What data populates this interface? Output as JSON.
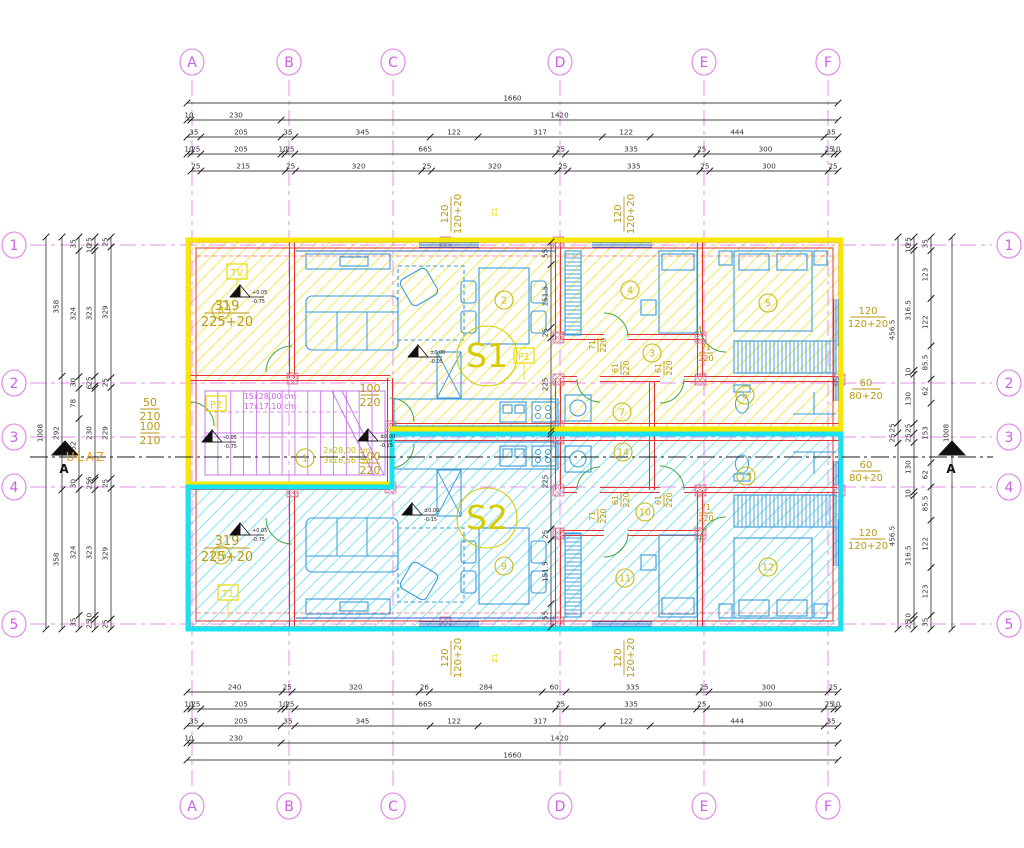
{
  "canvas": {
    "width": 1024,
    "height": 848,
    "bg": "#ffffff"
  },
  "colors": {
    "grid": "#e07ee8",
    "axis_text": "#cf5fe8",
    "unit1_border": "#f6e800",
    "unit2_border": "#19e3f2",
    "unit1_hatch": "#f2e23c",
    "unit2_hatch": "#5fe0ec",
    "wall": "#e03535",
    "dim_line": "#444444",
    "dim_text": "#333333",
    "olive": "#bb9912",
    "furniture": "#3b9bd9",
    "stair": "#c877e8",
    "room": "#c9b80e",
    "unit_label": "#d8ca00",
    "section": "#1a1a1a",
    "door": "#46a546",
    "window": "#2a62c8",
    "pier": "#e8a0c0",
    "orange": "#e8a02a",
    "label_yellow": "#e8dc00"
  },
  "axes": {
    "cols": [
      {
        "label": "A",
        "x": 192
      },
      {
        "label": "B",
        "x": 289
      },
      {
        "label": "C",
        "x": 393
      },
      {
        "label": "D",
        "x": 560
      },
      {
        "label": "E",
        "x": 704
      },
      {
        "label": "F",
        "x": 828
      }
    ],
    "rows": [
      {
        "label": "1",
        "y": 245
      },
      {
        "label": "2",
        "y": 383
      },
      {
        "label": "3",
        "y": 437
      },
      {
        "label": "4",
        "y": 487
      },
      {
        "label": "5",
        "y": 624
      }
    ],
    "top_cy": 62,
    "bottom_cy": 806,
    "left_cx": 14,
    "right_cx": 1009,
    "r": 13,
    "v_y1": 80,
    "v_y2": 790,
    "h_x1": 30,
    "h_x2": 992
  },
  "dim_chains": {
    "top": [
      {
        "y": 103,
        "x1": 187,
        "x2": 838,
        "values": [
          "1660"
        ]
      },
      {
        "y": 120,
        "x1": 187,
        "x2": 838,
        "values": [
          "10",
          "230",
          "1420"
        ]
      },
      {
        "y": 137,
        "x1": 187,
        "x2": 838,
        "values": [
          "35",
          "205",
          "35",
          "345",
          "122",
          "317",
          "122",
          "444",
          "35"
        ]
      },
      {
        "y": 154,
        "x1": 187,
        "x2": 838,
        "values": [
          "10",
          "25",
          "205",
          "10",
          "25",
          "665",
          "25",
          "335",
          "25",
          "300",
          "25",
          "10"
        ]
      },
      {
        "y": 171,
        "x1": 191,
        "x2": 838,
        "values": [
          "25",
          "215",
          "25",
          "320",
          "25",
          "320",
          "25",
          "335",
          "25",
          "300",
          "25"
        ]
      }
    ],
    "bottom": [
      {
        "y": 692,
        "x1": 187,
        "x2": 838,
        "values": [
          "240",
          "25",
          "320",
          "26",
          "284",
          "60",
          "335",
          "25",
          "300",
          "25"
        ]
      },
      {
        "y": 709,
        "x1": 187,
        "x2": 838,
        "values": [
          "10",
          "25",
          "205",
          "10",
          "25",
          "665",
          "25",
          "335",
          "25",
          "300",
          "25",
          "10"
        ]
      },
      {
        "y": 726,
        "x1": 187,
        "x2": 838,
        "values": [
          "35",
          "205",
          "35",
          "345",
          "122",
          "317",
          "122",
          "444",
          "35"
        ]
      },
      {
        "y": 743,
        "x1": 187,
        "x2": 838,
        "values": [
          "10",
          "230",
          "1420"
        ]
      },
      {
        "y": 760,
        "x1": 187,
        "x2": 838,
        "values": [
          "1660"
        ]
      }
    ],
    "left": [
      {
        "x": 46,
        "y1": 237,
        "y2": 629,
        "values": [
          "1008"
        ]
      },
      {
        "x": 62,
        "y1": 237,
        "y2": 629,
        "values": [
          "358",
          "292",
          "358"
        ]
      },
      {
        "x": 79,
        "y1": 237,
        "y2": 629,
        "values": [
          "35",
          "324",
          "30",
          "78",
          "152",
          "30",
          "324",
          "35"
        ]
      },
      {
        "x": 95,
        "y1": 237,
        "y2": 629,
        "values": [
          "25",
          "10",
          "323",
          "25",
          "6",
          "230",
          "6",
          "25",
          "323",
          "10",
          "25"
        ]
      },
      {
        "x": 111,
        "y1": 237,
        "y2": 629,
        "values": [
          "25",
          "329",
          "25",
          "229",
          "25",
          "329",
          "25"
        ]
      }
    ],
    "right": [
      {
        "x": 898,
        "y1": 237,
        "y2": 629,
        "values": [
          "456.5",
          "25",
          "25",
          "456.5"
        ]
      },
      {
        "x": 914,
        "y1": 237,
        "y2": 629,
        "values": [
          "25",
          "10",
          "316.5",
          "10",
          "130",
          "25",
          "25",
          "130",
          "10",
          "316.5",
          "10",
          "25"
        ]
      },
      {
        "x": 931,
        "y1": 237,
        "y2": 629,
        "values": [
          "35",
          "123",
          "122",
          "85.5",
          "62",
          "153",
          "62",
          "85.5",
          "122",
          "123",
          "35"
        ]
      },
      {
        "x": 952,
        "y1": 237,
        "y2": 629,
        "values": [
          "1008"
        ]
      }
    ],
    "interior": [
      {
        "x": 551,
        "y1": 242,
        "y2": 431,
        "values": [
          "55",
          "151.5",
          "25",
          "225"
        ]
      },
      {
        "x": 551,
        "y1": 434,
        "y2": 627,
        "values": [
          "225",
          "25",
          "151.5",
          "55"
        ]
      }
    ]
  },
  "rooms": [
    {
      "num": "1",
      "x": 305,
      "y": 458
    },
    {
      "num": "2",
      "x": 504,
      "y": 300
    },
    {
      "num": "3",
      "x": 652,
      "y": 353
    },
    {
      "num": "4",
      "x": 630,
      "y": 290
    },
    {
      "num": "5",
      "x": 768,
      "y": 303
    },
    {
      "num": "6",
      "x": 745,
      "y": 395
    },
    {
      "num": "7",
      "x": 622,
      "y": 412
    },
    {
      "num": "8",
      "x": 221,
      "y": 310
    },
    {
      "num": "9",
      "x": 504,
      "y": 566
    },
    {
      "num": "10",
      "x": 645,
      "y": 512
    },
    {
      "num": "11",
      "x": 625,
      "y": 578
    },
    {
      "num": "12",
      "x": 768,
      "y": 567
    },
    {
      "num": "13",
      "x": 746,
      "y": 476
    },
    {
      "num": "14",
      "x": 623,
      "y": 452
    },
    {
      "num": "15",
      "x": 221,
      "y": 555
    }
  ],
  "units": [
    {
      "label": "S1",
      "x": 487,
      "y": 356
    },
    {
      "label": "S2",
      "x": 487,
      "y": 518
    }
  ],
  "fractions": [
    {
      "top": "319",
      "bottom": "225+20",
      "x": 227,
      "y": 312,
      "size": 13,
      "rot": 0
    },
    {
      "top": "319",
      "bottom": "225+20",
      "x": 227,
      "y": 547,
      "size": 13,
      "rot": 0
    },
    {
      "top": "50",
      "bottom": "210",
      "x": 150,
      "y": 408,
      "size": 11,
      "rot": 0
    },
    {
      "top": "100",
      "bottom": "210",
      "x": 150,
      "y": 432,
      "size": 11,
      "rot": 0
    },
    {
      "top": "100",
      "bottom": "220",
      "x": 370,
      "y": 394,
      "size": 11,
      "rot": 0
    },
    {
      "top": "100",
      "bottom": "220",
      "x": 370,
      "y": 462,
      "size": 11,
      "rot": 0
    },
    {
      "top": "120",
      "bottom": "120+20",
      "x": 450,
      "y": 214,
      "size": 10,
      "rot": -90
    },
    {
      "top": "120",
      "bottom": "120+20",
      "x": 623,
      "y": 214,
      "size": 10,
      "rot": -90
    },
    {
      "top": "120",
      "bottom": "120+20",
      "x": 450,
      "y": 658,
      "size": 10,
      "rot": -90
    },
    {
      "top": "120",
      "bottom": "120+20",
      "x": 623,
      "y": 658,
      "size": 10,
      "rot": -90
    },
    {
      "top": "120",
      "bottom": "120+20",
      "x": 868,
      "y": 316,
      "size": 10,
      "rot": 0
    },
    {
      "top": "60",
      "bottom": "80+20",
      "x": 866,
      "y": 388,
      "size": 10,
      "rot": 0
    },
    {
      "top": "60",
      "bottom": "80+20",
      "x": 866,
      "y": 470,
      "size": 10,
      "rot": 0
    },
    {
      "top": "120",
      "bottom": "120+20",
      "x": 868,
      "y": 538,
      "size": 10,
      "rot": 0
    },
    {
      "top": "71",
      "bottom": "220",
      "x": 597,
      "y": 345,
      "size": 8,
      "rot": -90
    },
    {
      "top": "61",
      "bottom": "220",
      "x": 620,
      "y": 368,
      "size": 8,
      "rot": -90
    },
    {
      "top": "61",
      "bottom": "220",
      "x": 663,
      "y": 368,
      "size": 8,
      "rot": -90
    },
    {
      "top": "71",
      "bottom": "220",
      "x": 706,
      "y": 352,
      "size": 8,
      "rot": 0
    },
    {
      "top": "71",
      "bottom": "220",
      "x": 597,
      "y": 516,
      "size": 8,
      "rot": -90
    },
    {
      "top": "61",
      "bottom": "220",
      "x": 620,
      "y": 500,
      "size": 8,
      "rot": -90
    },
    {
      "top": "61",
      "bottom": "220",
      "x": 663,
      "y": 500,
      "size": 8,
      "rot": -90
    },
    {
      "top": "71",
      "bottom": "220",
      "x": 706,
      "y": 512,
      "size": 8,
      "rot": 0
    }
  ],
  "texts": [
    {
      "text": "ULAZ",
      "x": 86,
      "y": 461,
      "size": 12,
      "color": "#e8a02a",
      "rot": 0,
      "spacing": 2
    },
    {
      "text": "15x28,00 cm",
      "x": 270,
      "y": 399,
      "size": 8,
      "color": "#cf5fe8",
      "rot": 0,
      "spacing": 0
    },
    {
      "text": "17x17,10 cm",
      "x": 270,
      "y": 409,
      "size": 8,
      "color": "#cf5fe8",
      "rot": 0,
      "spacing": 0
    },
    {
      "text": "2x28,00 cm",
      "x": 347,
      "y": 453,
      "size": 8,
      "color": "#c9b80e",
      "rot": 0,
      "spacing": 0
    },
    {
      "text": "3x16,56 cm",
      "x": 347,
      "y": 463,
      "size": 8,
      "color": "#c9b80e",
      "rot": 0,
      "spacing": 0
    },
    {
      "text": "Z1",
      "x": 497,
      "y": 212,
      "size": 7,
      "color": "#e8dc00",
      "rot": -90,
      "spacing": 0
    },
    {
      "text": "Z1",
      "x": 497,
      "y": 658,
      "size": 7,
      "color": "#e8dc00",
      "rot": -90,
      "spacing": 0
    }
  ],
  "tag_boxes": [
    {
      "label": "TV",
      "x": 237,
      "y": 272
    },
    {
      "label": "P2",
      "x": 216,
      "y": 404
    },
    {
      "label": "P1",
      "x": 524,
      "y": 356
    },
    {
      "label": "T1",
      "x": 228,
      "y": 593
    }
  ],
  "levels": [
    {
      "top": "+0.05",
      "bottom": "-0.75",
      "x": 240,
      "y": 292
    },
    {
      "top": "±0.00",
      "bottom": "-0.05",
      "x": 418,
      "y": 352
    },
    {
      "top": "-0.05",
      "bottom": "-0.75",
      "x": 212,
      "y": 437
    },
    {
      "top": "±0.00",
      "bottom": "-0.15",
      "x": 368,
      "y": 436
    },
    {
      "top": "+0.05",
      "bottom": "-0.75",
      "x": 240,
      "y": 530
    },
    {
      "top": "±0.00",
      "bottom": "-0.15",
      "x": 412,
      "y": 510
    }
  ],
  "section": {
    "label": "A",
    "y": 457,
    "x1": 30,
    "x2": 993,
    "marks": [
      65,
      952
    ]
  }
}
